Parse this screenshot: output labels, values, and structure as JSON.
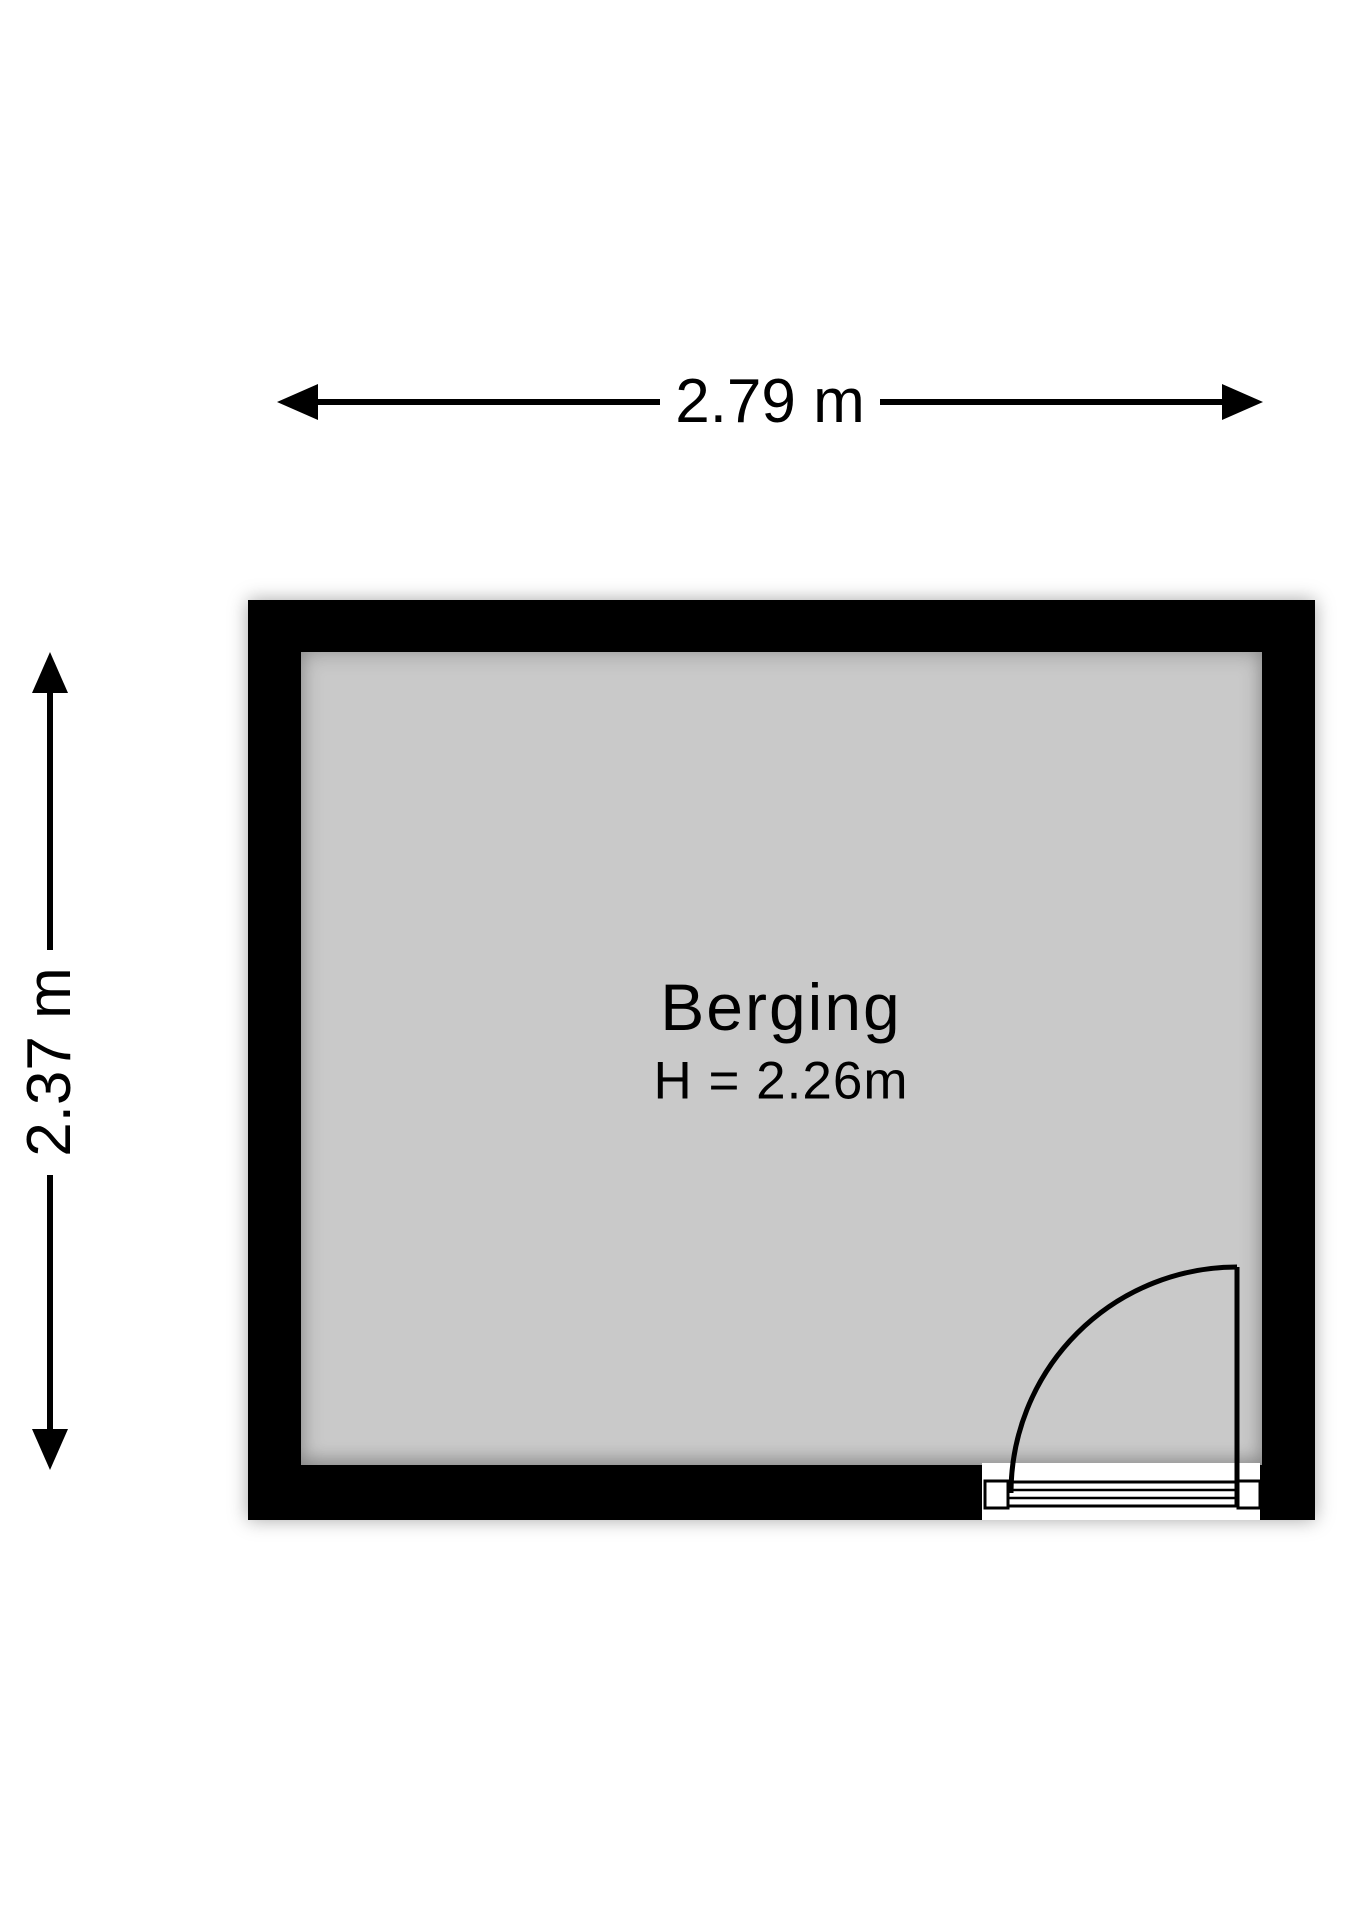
{
  "colors": {
    "background": "#ffffff",
    "wall": "#000000",
    "floor": "#c9c9c9",
    "line": "#000000",
    "text": "#000000",
    "opening": "#ffffff"
  },
  "dimensions": {
    "width_label": "2.79 m",
    "height_label": "2.37 m"
  },
  "room": {
    "name": "Berging",
    "ceiling_height_label": "H = 2.26m"
  }
}
